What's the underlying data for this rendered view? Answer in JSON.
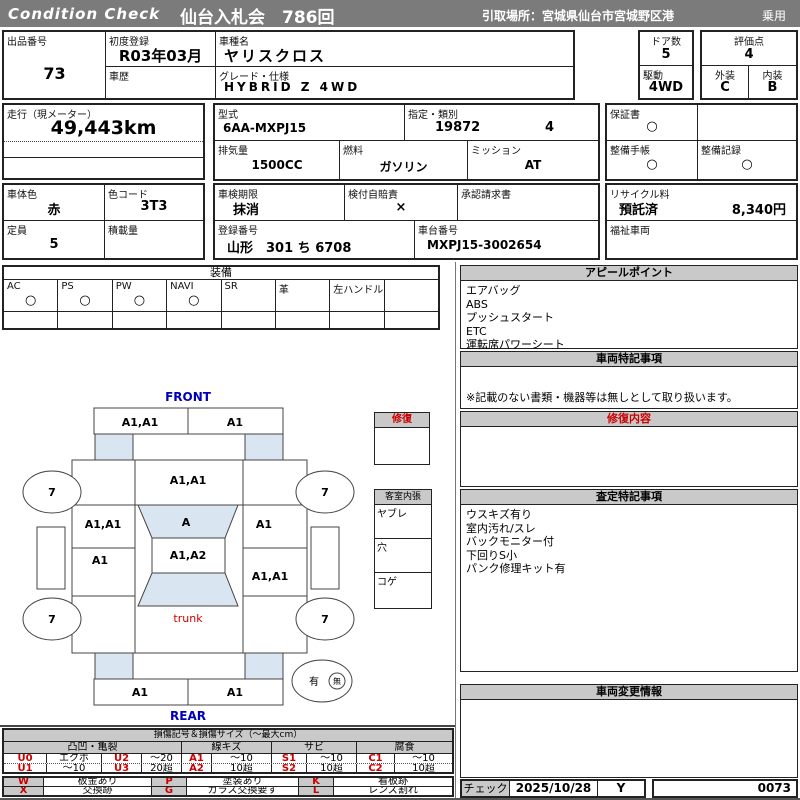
{
  "colors": {
    "header_bar": "#7b7b7b",
    "panel_header": "#c9c9c9",
    "diagram_highlight": "#d9e5f1",
    "accent_red": "#cc0000",
    "accent_blue": "#0000bb"
  },
  "header": {
    "brand": "Condition Check",
    "title": "仙台入札会　786回",
    "pickup": "引取場所：宮城県仙台市宮城野区港",
    "category": "乗用"
  },
  "info": {
    "lot_label": "出品番号",
    "lot_value": "73",
    "first_reg_label": "初度登録",
    "first_reg_value": "R03年03月",
    "history_label": "車歴",
    "model_name_label": "車種名",
    "model_name_value": "ヤリスクロス",
    "grade_label": "グレード・仕様",
    "grade_value": "HYBRID Z 4WD",
    "doors_label": "ドア数",
    "doors_value": "5",
    "score_label": "評価点",
    "score_value": "4",
    "drive_label": "駆動",
    "drive_value": "4WD",
    "exterior_label": "外装",
    "exterior_value": "C",
    "interior_label": "内装",
    "interior_value": "B",
    "mileage_label": "走行（現メーター）",
    "mileage_value": "49,443km",
    "model_code_label": "型式",
    "model_code_value": "6AA-MXPJ15",
    "type_class_label": "指定・類別",
    "type_value": "19872",
    "class_value": "4",
    "displacement_label": "排気量",
    "displacement_value": "1500CC",
    "fuel_label": "燃料",
    "fuel_value": "ガソリン",
    "transmission_label": "ミッション",
    "transmission_value": "AT",
    "warranty_label": "保証書",
    "warranty_value": "○",
    "maintenance_book_label": "整備手帳",
    "maintenance_book_value": "○",
    "maintenance_record_label": "整備記録",
    "maintenance_record_value": "○",
    "body_color_label": "車体色",
    "body_color_value": "赤",
    "color_code_label": "色コード",
    "color_code_value": "3T3",
    "inspection_label": "車検期限",
    "inspection_value": "抹消",
    "insurance_label": "検付自賠責",
    "insurance_value": "×",
    "approval_label": "承認請求書",
    "capacity_label": "定員",
    "capacity_value": "5",
    "load_label": "積載量",
    "reg_number_label": "登録番号",
    "reg_number_value": "山形　301 ち 6708",
    "chassis_label": "車台番号",
    "chassis_value": "MXPJ15-3002654",
    "recycle_label": "リサイクル料",
    "recycle_status": "預託済",
    "recycle_fee": "8,340円",
    "welfare_label": "福祉車両"
  },
  "equipment": {
    "title": "装備",
    "items": [
      {
        "label": "AC",
        "value": "○"
      },
      {
        "label": "PS",
        "value": "○"
      },
      {
        "label": "PW",
        "value": "○"
      },
      {
        "label": "NAVI",
        "value": "○"
      },
      {
        "label": "SR",
        "value": ""
      },
      {
        "label": "革",
        "value": ""
      },
      {
        "label": "左ハンドル",
        "value": ""
      },
      {
        "label": "",
        "value": ""
      }
    ]
  },
  "panels": {
    "appeal": {
      "title": "アピールポイント",
      "items": [
        "エアバッグ",
        "ABS",
        "プッシュスタート",
        "ETC",
        "運転席パワーシート"
      ]
    },
    "vehicle_notes": {
      "title": "車両特記事項",
      "note": "※記載のない書類・機器等は無しとして取り扱います。"
    },
    "repair_details": {
      "title": "修復内容"
    },
    "assessment_notes": {
      "title": "査定特記事項",
      "items": [
        "ウスキズ有り",
        "室内汚れ/スレ",
        "バックモニター付",
        "下回りS小",
        "パンク修理キット有"
      ]
    },
    "change_info": {
      "title": "車両変更情報"
    },
    "check": {
      "label": "チェック",
      "date": "2025/10/28",
      "inspector": "Y",
      "number": "0073"
    }
  },
  "diagram": {
    "front_label": "FRONT",
    "rear_label": "REAR",
    "front_bumper_left": "A1,A1",
    "front_bumper_right": "A1",
    "hood": "A1,A1",
    "windshield": "A",
    "roof": "A1,A2",
    "left_front_panel": "A1,A1",
    "left_rear_panel": "A1",
    "right_front_panel": "A1",
    "right_rear_panel": "A1,A1",
    "trunk_label": "trunk",
    "rear_bumper_left": "A1",
    "rear_bumper_right": "A1",
    "wheel_mark": "7",
    "repair_box_title": "修復",
    "interior_box_title": "客室内張",
    "interior_rows": [
      "ヤブレ",
      "穴",
      "コゲ"
    ],
    "spare_yes": "有",
    "spare_no": "無"
  },
  "legend": {
    "title": "損傷記号＆損傷サイズ（～最大cm）",
    "groups": [
      "凸凹・亀裂",
      "線キズ",
      "サビ",
      "腐食"
    ],
    "rows": [
      [
        {
          "code": "U0",
          "desc": "エクボ"
        },
        {
          "code": "U2",
          "desc": "～20"
        },
        {
          "code": "A1",
          "desc": "～10"
        },
        {
          "code": "S1",
          "desc": "～10"
        },
        {
          "code": "C1",
          "desc": "～10"
        }
      ],
      [
        {
          "code": "U1",
          "desc": "～10"
        },
        {
          "code": "U3",
          "desc": "20超"
        },
        {
          "code": "A2",
          "desc": "10超"
        },
        {
          "code": "S2",
          "desc": "10超"
        },
        {
          "code": "C2",
          "desc": "10超"
        }
      ]
    ],
    "marks": [
      [
        {
          "code": "W",
          "desc": "板金あり"
        },
        {
          "code": "P",
          "desc": "塗装あり"
        },
        {
          "code": "K",
          "desc": "看板跡"
        }
      ],
      [
        {
          "code": "X",
          "desc": "交換跡"
        },
        {
          "code": "G",
          "desc": "ガラス交換要す"
        },
        {
          "code": "L",
          "desc": "レンズ割れ"
        }
      ]
    ]
  }
}
